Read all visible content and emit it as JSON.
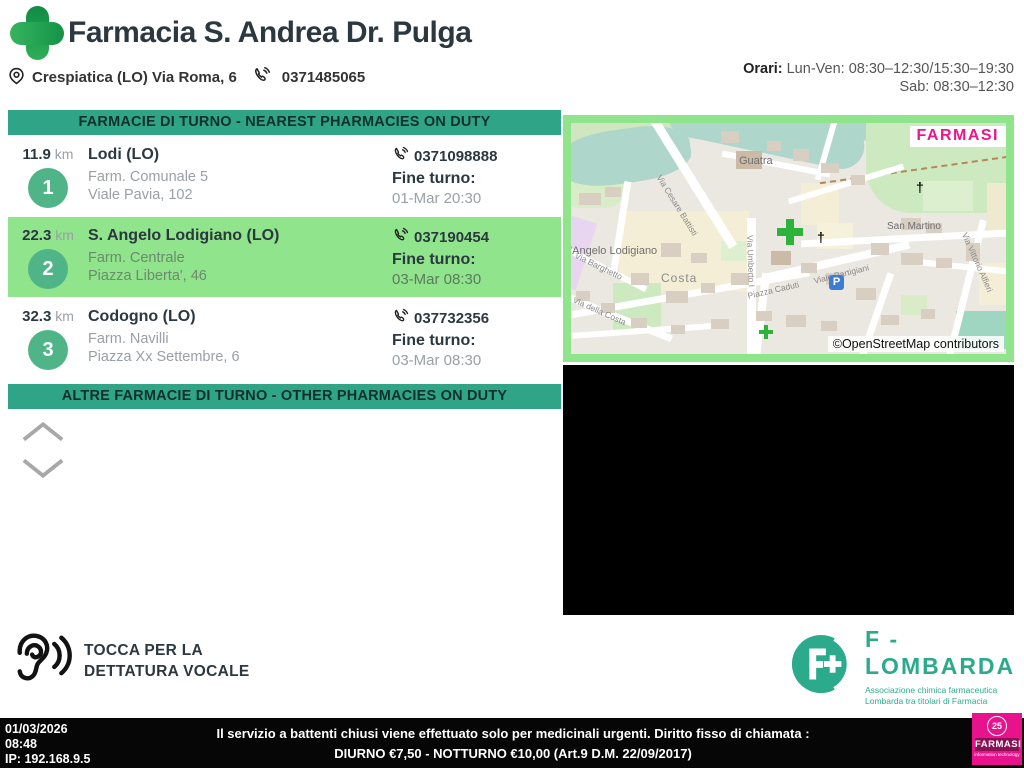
{
  "header": {
    "title": "Farmacia S. Andrea Dr. Pulga",
    "address": "Crespiatica (LO) Via Roma, 6",
    "phone": "0371485065",
    "hours_label": "Orari:",
    "hours_line1": " Lun-Ven: 08:30–12:30/15:30–19:30",
    "hours_line2": "Sab: 08:30–12:30"
  },
  "labels": {
    "nearest_banner": "FARMACIE DI TURNO - NEAREST PHARMACIES ON DUTY",
    "other_banner": "ALTRE FARMACIE DI TURNO - OTHER PHARMACIES ON DUTY",
    "km": "km",
    "fine_turno": "Fine turno:"
  },
  "pharmacies": [
    {
      "distance": "11.9",
      "rank": "1",
      "city": "Lodi (LO)",
      "name": "Farm. Comunale 5",
      "address": "Viale Pavia, 102",
      "phone": "0371098888",
      "end": "01-Mar 20:30"
    },
    {
      "distance": "22.3",
      "rank": "2",
      "city": "S. Angelo Lodigiano (LO)",
      "name": "Farm. Centrale",
      "address": "Piazza Liberta', 46",
      "phone": "037190454",
      "end": "03-Mar 08:30"
    },
    {
      "distance": "32.3",
      "rank": "3",
      "city": "Codogno (LO)",
      "name": "Farm. Navilli",
      "address": "Piazza Xx Settembre, 6",
      "phone": "037732356",
      "end": "03-Mar 08:30"
    }
  ],
  "map": {
    "watermark": "FARMASI",
    "attribution": "©OpenStreetMap contributors",
    "parking": "P",
    "labels": {
      "guatra": "Guatra",
      "san_martino": "San Martino",
      "costa": "Costa",
      "sant_angelo": "t'Angelo Lodigiano",
      "piazza_caduti": "Piazza Caduti",
      "viale_partigiani": "Viale Partigiani",
      "via_barghetto": "Via Barghetto",
      "via_della_costa": "Via della Costa",
      "via_cesare_battisti": "Via Cesare Battisti",
      "via_umberto": "Via Umberto I",
      "via_vittorio_alfieri": "Via Vittorio Alfieri"
    }
  },
  "voice": {
    "line1": "TOCCA PER LA",
    "line2": "DETTATURA VOCALE"
  },
  "flombarda": {
    "name": "F - LOMBARDA",
    "sub1": "Associazione chimica farmaceutica",
    "sub2": "Lombarda tra titolari di Farmacia"
  },
  "footer": {
    "date": "01/03/2026",
    "time": "08:48",
    "ip": "IP: 192.168.9.5",
    "notice": "Il servizio a battenti chiusi viene effettuato solo per medicinali urgenti. Diritto fisso di chiamata : DIURNO €7,50 - NOTTURNO €10,00 (Art.9 D.M. 22/09/2017)",
    "farmasi_badge": "25",
    "farmasi_name": "FARMASI",
    "farmasi_sub": "information technology"
  },
  "colors": {
    "banner_green": "#2fa487",
    "highlight_green": "#8fe48c",
    "circle_green": "#50b489",
    "logo_green_dark": "#0f8c43",
    "logo_green_light": "#2fae57",
    "farmasi_magenta": "#e8128c",
    "flombarda_green": "#2bab8c"
  }
}
